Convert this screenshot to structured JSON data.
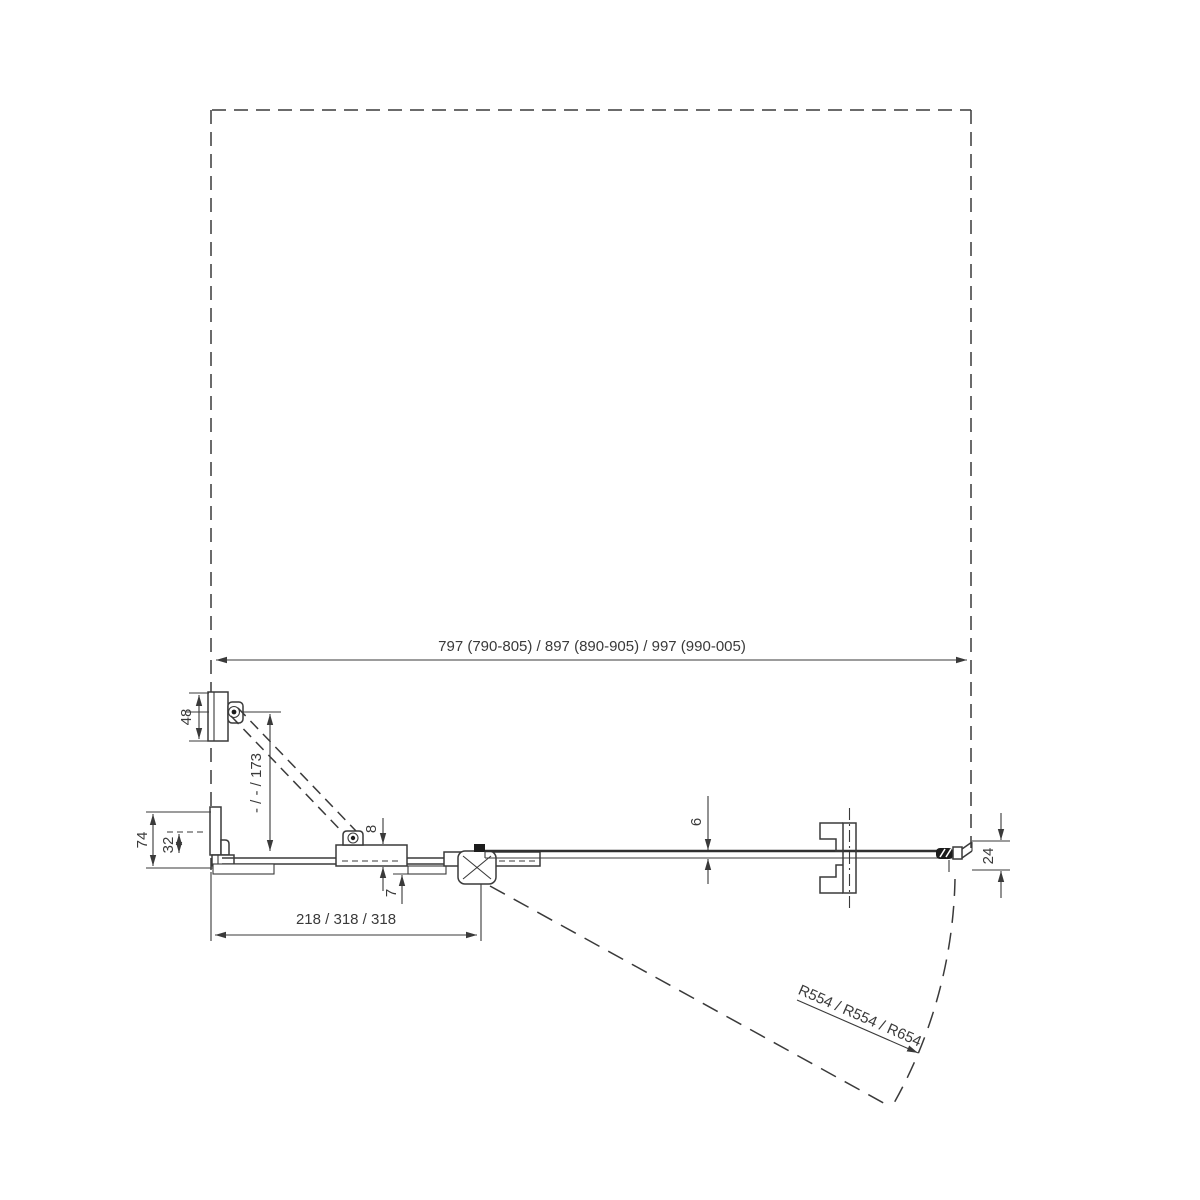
{
  "drawing": {
    "background": "#ffffff",
    "line_color": "#3a3a3a",
    "handle_color": "#1c1c1c",
    "dimensions": {
      "overall_width": "797 (790-805) / 897 (890-905) / 997 (990-005)",
      "fixed_segment_width": "218 / 318 / 318",
      "door_swing_radius": "R554 / R554 / R654",
      "support_bar_length": "- / - / 173",
      "wall_bracket_height": "48",
      "wall_profile_depth": "74",
      "wall_profile_adjustment": "32",
      "glass_offset": "8",
      "panel_offset": "7",
      "glass_thickness": "6",
      "door_edge_clearance": "24"
    }
  }
}
